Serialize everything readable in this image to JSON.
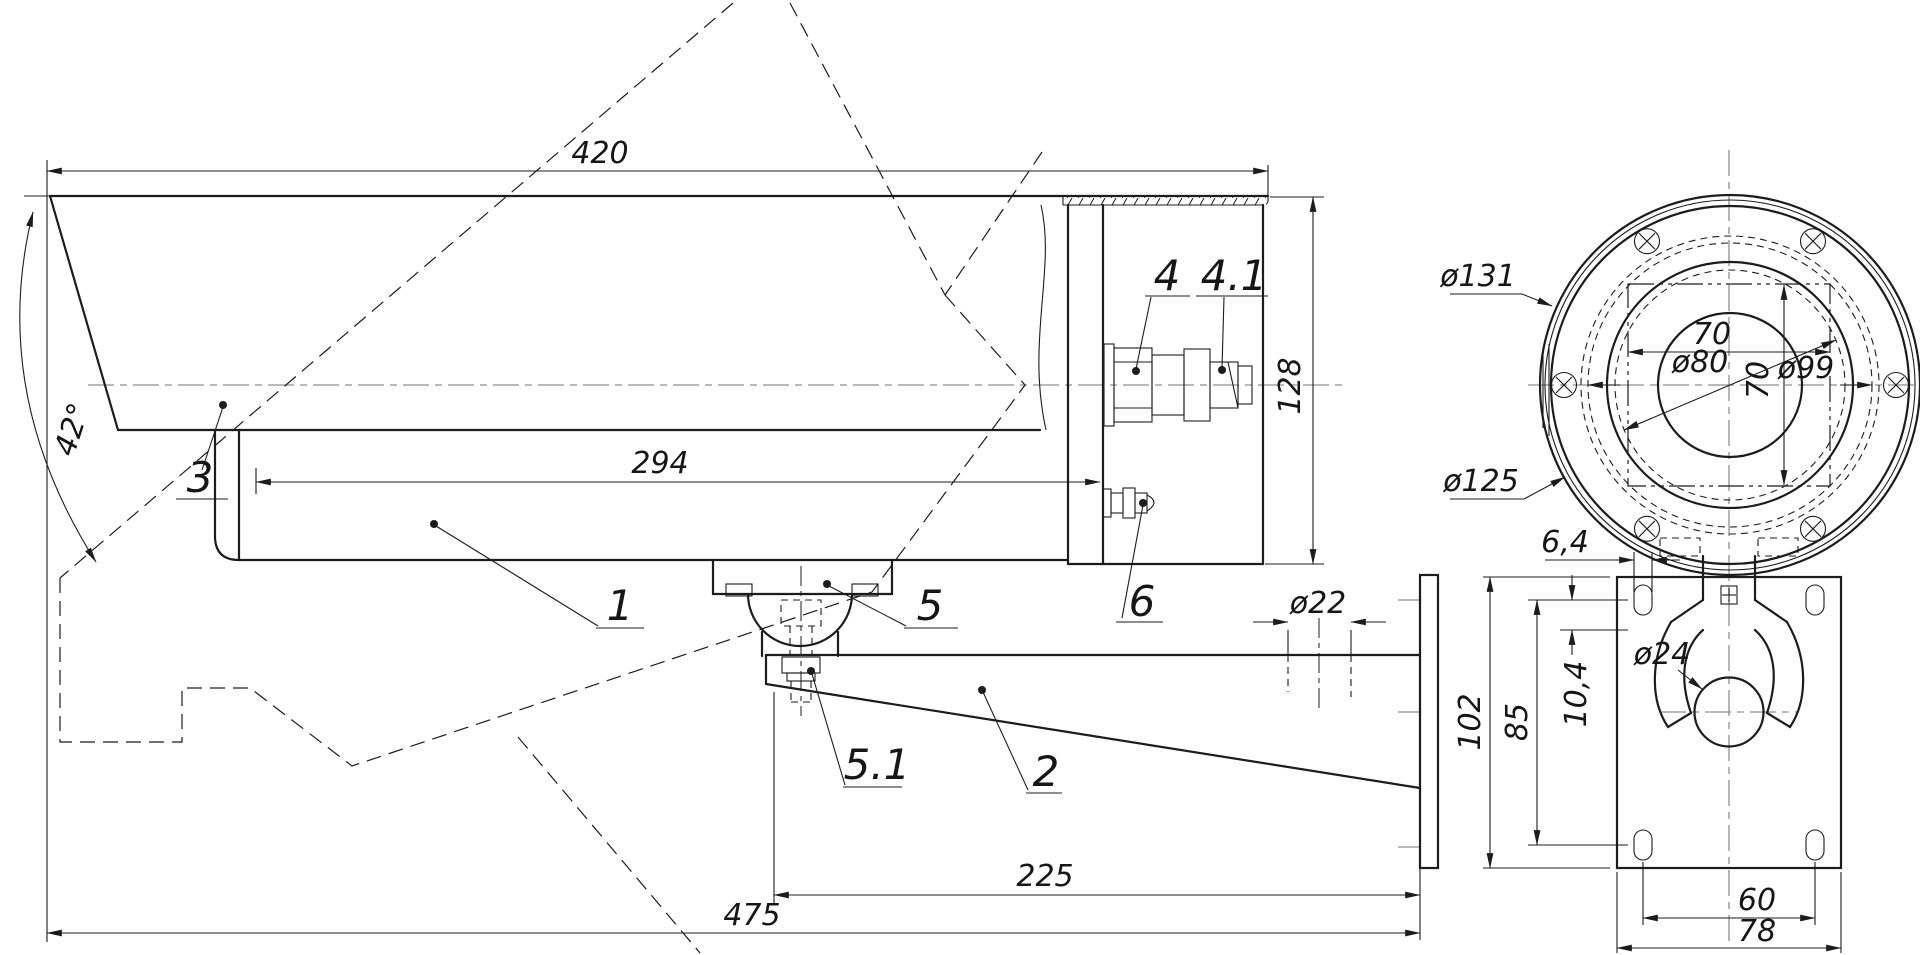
{
  "meta": {
    "background": "#ffffff",
    "line_color": "#1c1c1c",
    "centerline_color": "#8f8f8f",
    "drawing_type": "technical dimension drawing, CCTV camera housing with wall bracket"
  },
  "side_view": {
    "dims": {
      "overall_length": "420",
      "opening_angle": "42°",
      "body_length": "294",
      "rear_height": "128",
      "cable_hole": "ø22",
      "arm_length": "225",
      "overall_depth": "475"
    },
    "parts": {
      "housing": "1",
      "bracket_arm": "2",
      "sun_shield": "3",
      "connector": "4",
      "connector_plug": "4.1",
      "ball_joint": "5",
      "ball_bolt": "5.1",
      "cable_gland": "6"
    }
  },
  "front_view_camera": {
    "dims": {
      "outer_rim": "ø131",
      "flange": "ø125",
      "window_width": "70",
      "glass": "ø80",
      "window_height": "70",
      "bolt_circle": "ø99"
    }
  },
  "front_view_bracket": {
    "dims": {
      "slot_width": "6,4",
      "slot_height": "10,4",
      "hole_spacing_vertical": "85",
      "plate_height": "102",
      "pivot_hole": "ø24",
      "hole_spacing_horizontal": "60",
      "plate_width": "78"
    }
  }
}
